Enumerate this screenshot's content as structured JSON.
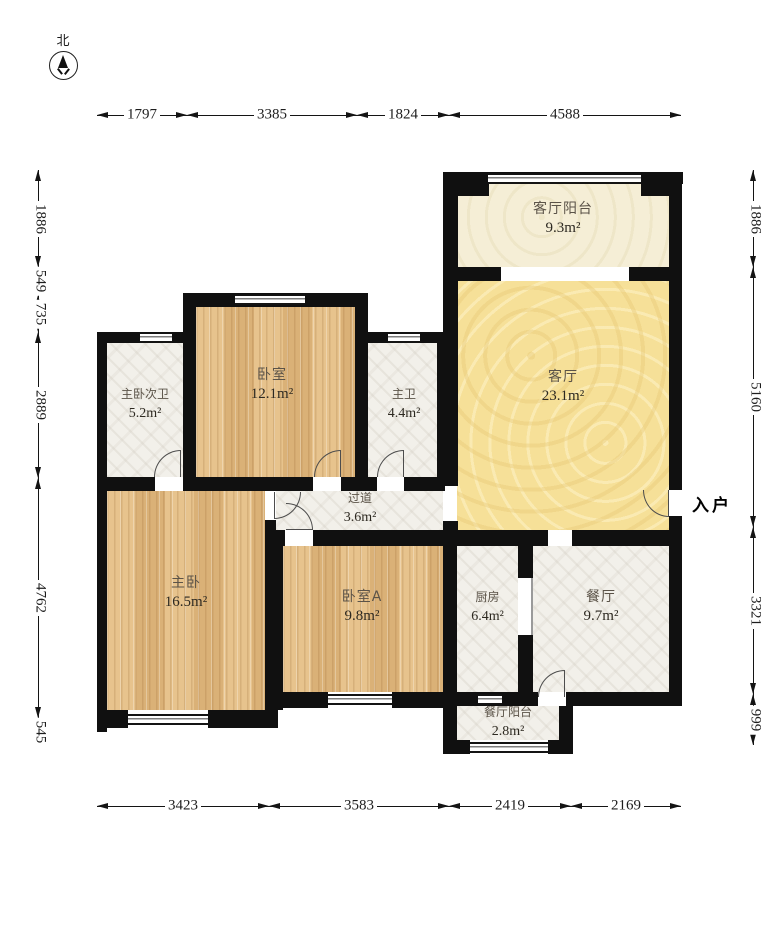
{
  "compass": {
    "label": "北"
  },
  "entrance": {
    "label": "入户"
  },
  "rooms": {
    "balcony_top": {
      "name": "客厅阳台",
      "area": "9.3m²"
    },
    "living": {
      "name": "客厅",
      "area": "23.1m²"
    },
    "master_bath2": {
      "name": "主卧次卫",
      "area": "5.2m²"
    },
    "bedroom": {
      "name": "卧室",
      "area": "12.1m²"
    },
    "master_bath": {
      "name": "主卫",
      "area": "4.4m²"
    },
    "hallway": {
      "name": "过道",
      "area": "3.6m²"
    },
    "master_bedroom": {
      "name": "主卧",
      "area": "16.5m²"
    },
    "bedroom_a": {
      "name": "卧室A",
      "area": "9.8m²"
    },
    "kitchen": {
      "name": "厨房",
      "area": "6.4m²"
    },
    "dining": {
      "name": "餐厅",
      "area": "9.7m²"
    },
    "dining_balcony": {
      "name": "餐厅阳台",
      "area": "2.8m²"
    }
  },
  "dimensions": {
    "top": [
      "1797",
      "3385",
      "1824",
      "4588"
    ],
    "bottom": [
      "3423",
      "3583",
      "2419",
      "2169"
    ],
    "left": [
      "1886",
      "549",
      "735",
      "2889",
      "4762",
      "545"
    ],
    "right": [
      "1886",
      "5160",
      "3321",
      "999"
    ]
  },
  "colors": {
    "wall": "#101010",
    "wood_floor": "#e1bb84",
    "marble_floor": "#f2f0ea",
    "living_floor": "#f6e098",
    "balcony_floor": "#f5eed6"
  }
}
